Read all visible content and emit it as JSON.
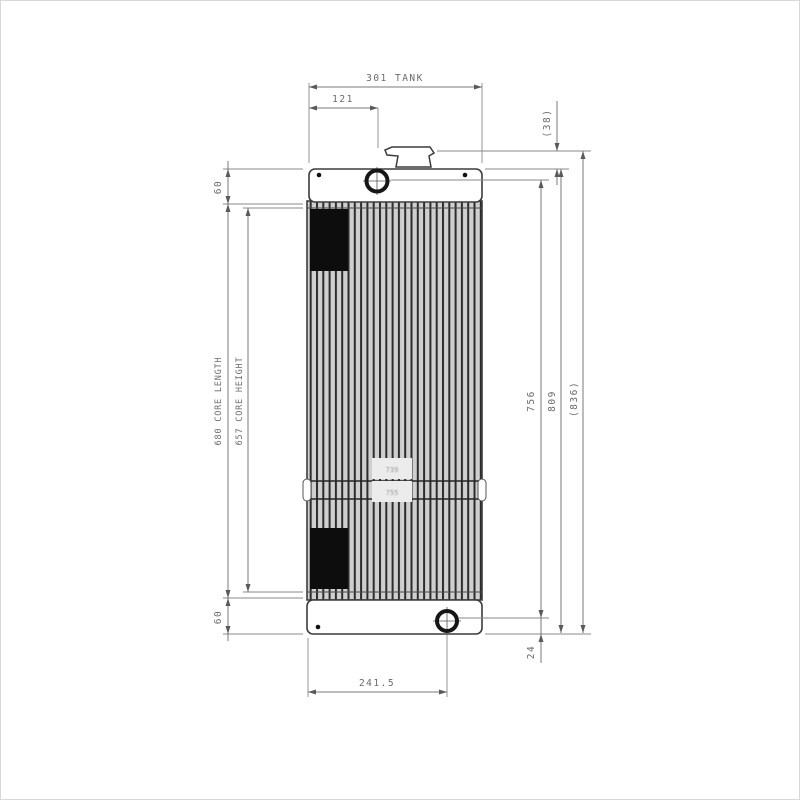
{
  "dims": {
    "tank_width": "301 TANK",
    "filler_offset_x": "121",
    "cap_height": "(38)",
    "top_flange": "60",
    "core_length": "680 CORE LENGTH",
    "core_height": "657 CORE HEIGHT",
    "bottom_flange": "60",
    "pin_span": "756",
    "tank_overall_height": "809",
    "overall_height_with_cap": "(836)",
    "bottom_pin_offset_y": "24",
    "bottom_pin_offset_x": "241.5"
  },
  "stamp": {
    "line1": "739",
    "line2": "755"
  },
  "colors": {
    "part_line": "#3c3c3c",
    "dim_line": "#7a7a7a",
    "dim_text": "#6a6a6a",
    "fin_light": "#cfcfcf",
    "fin_dark": "#2c2c2c",
    "block_fill": "#0d0d0d"
  }
}
